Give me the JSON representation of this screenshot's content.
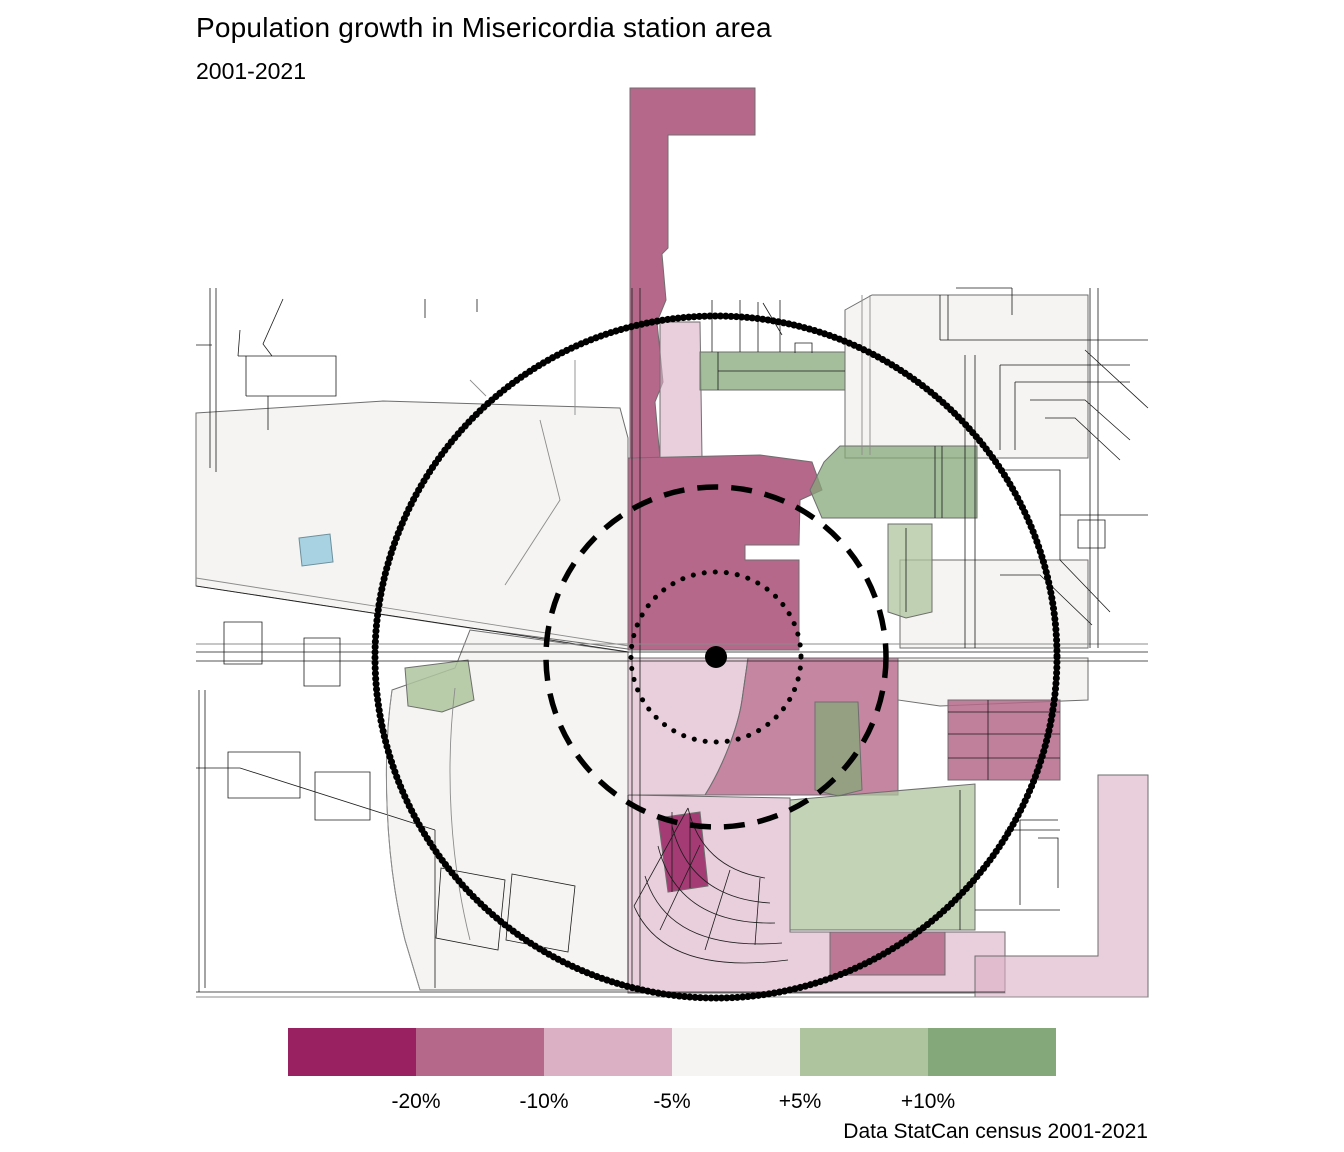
{
  "title": "Population growth in Misericordia station area",
  "subtitle": "2001-2021",
  "caption": "Data StatCan census 2001-2021",
  "legend": {
    "swatches": [
      {
        "name": "loss-below-20pct",
        "color": "#992161"
      },
      {
        "name": "loss-20-to-10pct",
        "color": "#b5688a"
      },
      {
        "name": "loss-10-to-5pct",
        "color": "#dbafc4"
      },
      {
        "name": "stable-5-to-5pct",
        "color": "#f5f4f2"
      },
      {
        "name": "gain-5-to-10pct",
        "color": "#aec49e"
      },
      {
        "name": "gain-above-10pct",
        "color": "#85a87a"
      }
    ],
    "labels": [
      "-20%",
      "-10%",
      "-5%",
      "+5%",
      "+10%"
    ]
  },
  "map": {
    "type": "choropleth_map",
    "theme": "population growth by census area, shaded from magenta (decline) to green (growth)",
    "station": {
      "marker": "black dot",
      "x_px": 716,
      "y_px": 657
    },
    "buffers": [
      {
        "name": "inner-buffer",
        "style": "dotted",
        "radius_px": 85
      },
      {
        "name": "middle-buffer",
        "style": "dashed",
        "radius_px": 170
      },
      {
        "name": "outer-buffer",
        "style": "bold-dotted",
        "radius_px": 341
      }
    ],
    "water_color": "#a8d2e2"
  }
}
